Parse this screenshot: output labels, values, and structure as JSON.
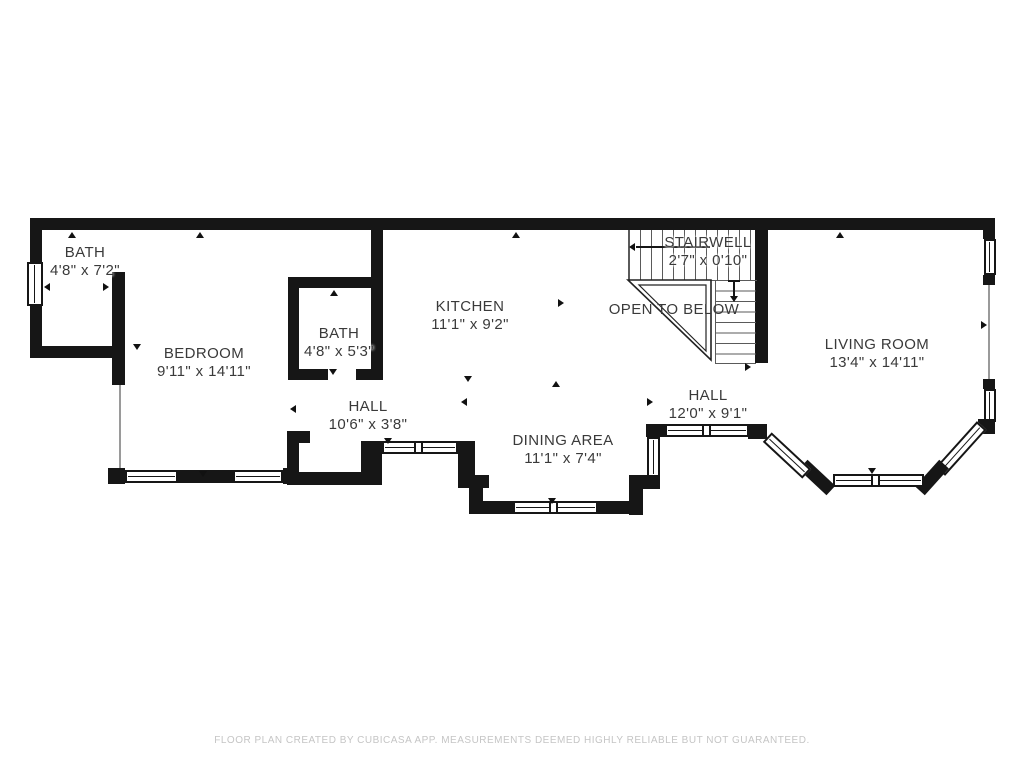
{
  "colors": {
    "wall": "#161616",
    "tread_line": "#5a5a5a",
    "label_text": "#3a3a3a",
    "footer_text": "#c5c5c5",
    "background": "#ffffff"
  },
  "rooms": [
    {
      "id": "bath-1",
      "label": "BATH",
      "dims": "4'8\" x 7'2\""
    },
    {
      "id": "bedroom",
      "label": "BEDROOM",
      "dims": "9'11\" x 14'11\""
    },
    {
      "id": "bath-2",
      "label": "BATH",
      "dims": "4'8\" x 5'3\""
    },
    {
      "id": "kitchen",
      "label": "KITCHEN",
      "dims": "11'1\" x 9'2\""
    },
    {
      "id": "stairwell",
      "label": "STAIRWELL",
      "dims": "2'7\" x 0'10\""
    },
    {
      "id": "open-to-below",
      "label": "OPEN TO BELOW",
      "dims": ""
    },
    {
      "id": "living-room",
      "label": "LIVING ROOM",
      "dims": "13'4\" x 14'11\""
    },
    {
      "id": "hall-1",
      "label": "HALL",
      "dims": "10'6\" x 3'8\""
    },
    {
      "id": "dining-area",
      "label": "DINING AREA",
      "dims": "11'1\" x 7'4\""
    },
    {
      "id": "hall-2",
      "label": "HALL",
      "dims": "12'0\" x 9'1\""
    }
  ],
  "footer": {
    "text": "FLOOR PLAN CREATED BY CUBICASA APP. MEASUREMENTS DEEMED HIGHLY RELIABLE BUT NOT GUARANTEED."
  }
}
